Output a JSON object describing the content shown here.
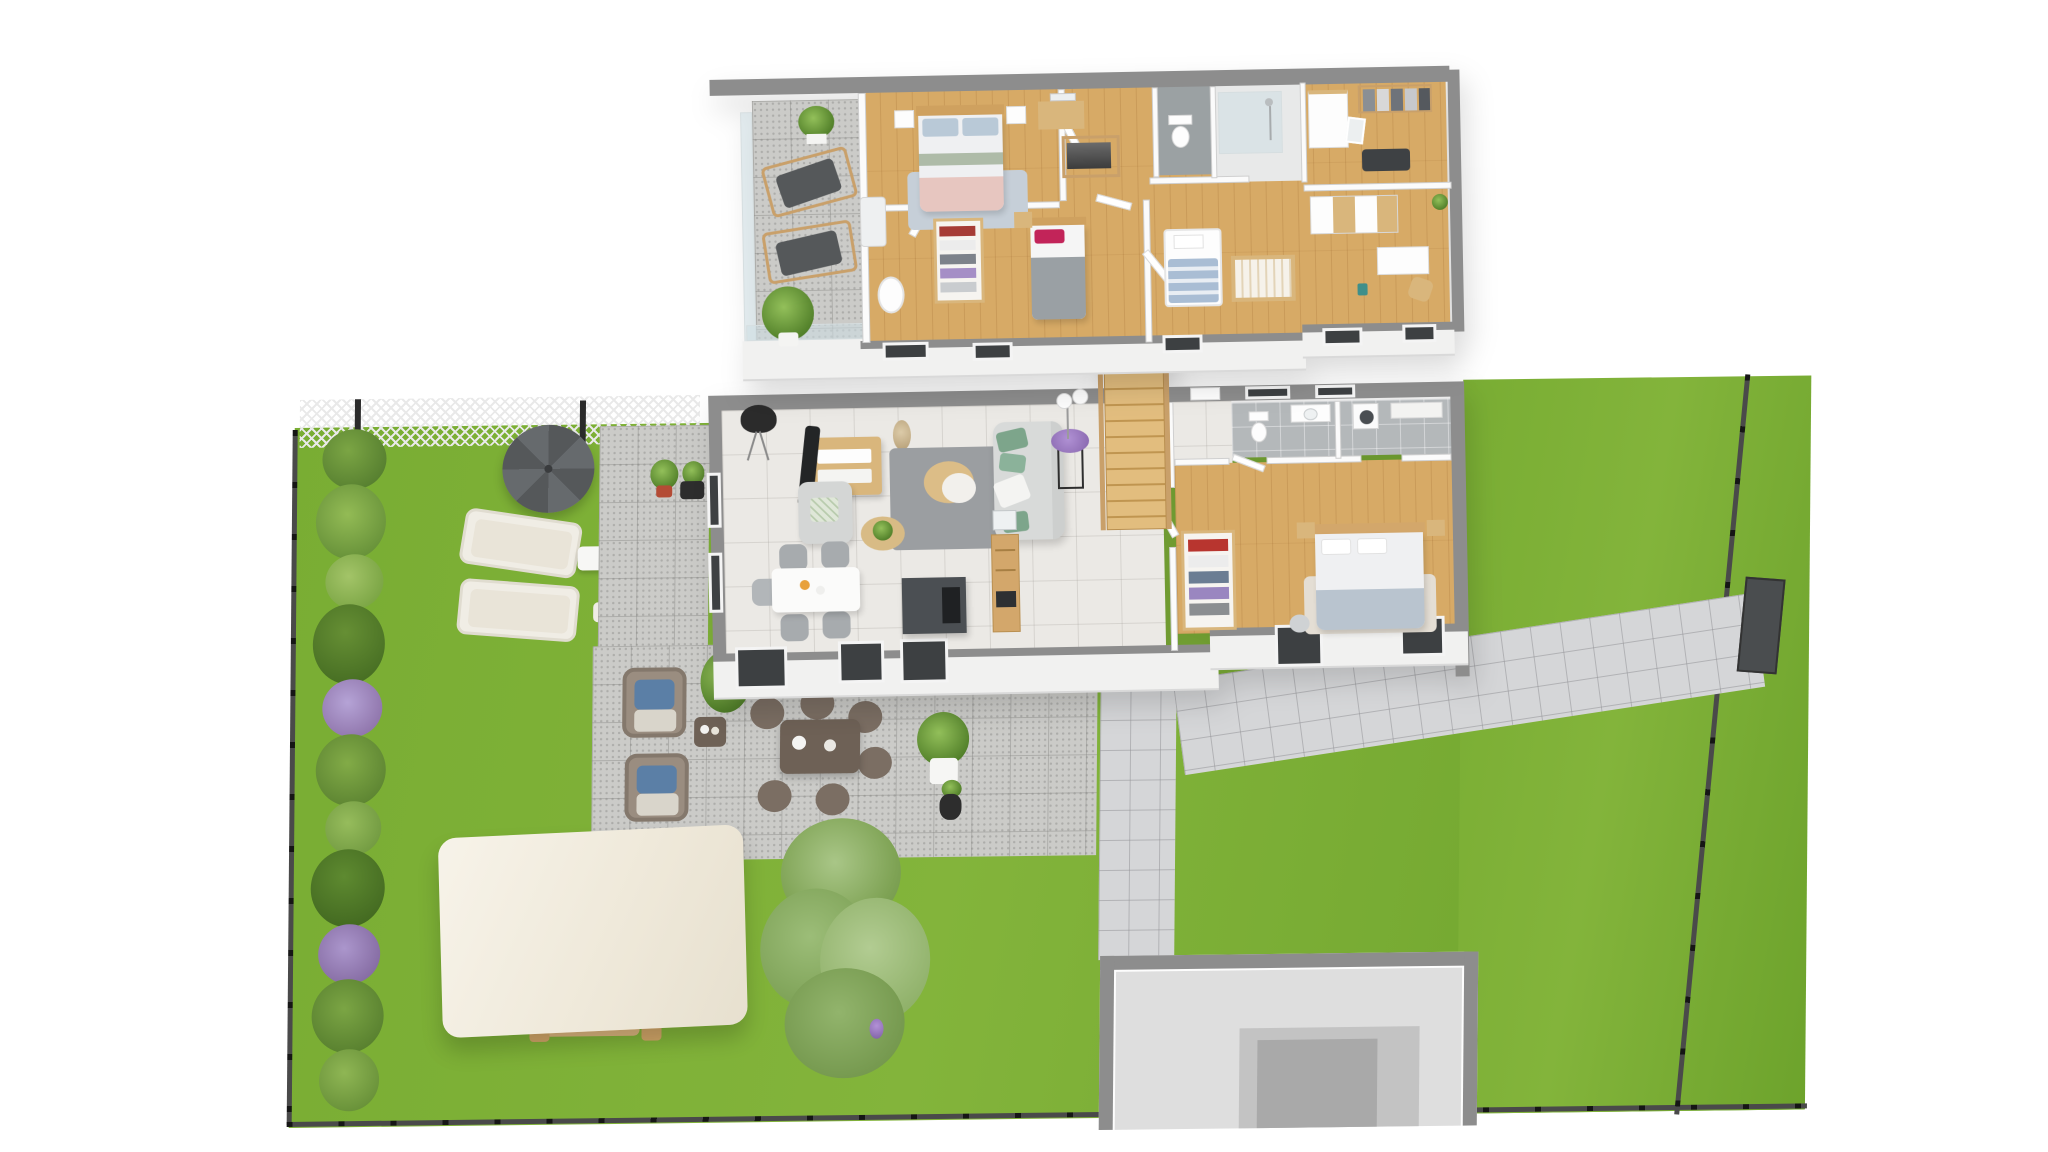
{
  "scene": {
    "title": "3D floor plan rendering - two-storey house with garden",
    "projection": "pseudo-isometric top-down view",
    "background": "#ffffff",
    "text_visible": "none"
  },
  "colors": {
    "grass": "#79ad33",
    "grass2": "#6da32c",
    "wallCap": "#8d8d8d",
    "wallFace": "#f1f1f0",
    "wood": "#d7aa66",
    "tile": "#ebe9e5",
    "terraceTile": "#cbcbc8",
    "pavers": "#d5d6d8",
    "bathTile": "#b4b8ba",
    "fence": "#2e2e2e",
    "hedgeGreen": "#6f9c3a",
    "hedgeDark": "#4f7c2b",
    "hedgeLight": "#8db252",
    "hedgePurple": "#9a84c0",
    "treeGreen": "#8fb168",
    "umbrella": "#5a5d5f",
    "loungerCushion": "#e9e4d8",
    "wicker": "#8a7d72",
    "outdoorTable": "#6e6156",
    "pergolaCanopy": "#f3eee2",
    "pergolaWood": "#c9a06a",
    "sofa": "#d8dad9",
    "cushionGreen": "#7da58b",
    "rugGray": "#9b9ea1",
    "tv": "#232526",
    "furnWood": "#d9b67c",
    "island": "#4b4f53",
    "chairGray": "#a7abae",
    "duvet": "#eff0f2",
    "pillowBlue": "#b9c9d7",
    "blanketPink": "#e7c6c0",
    "blanketGray": "#9aa0a4",
    "pillowMagenta": "#c22459",
    "blanketBlue": "#b9c4cf",
    "stairWood": "#e2bd7e",
    "glass": "#cfdfe4"
  },
  "upper_floor": {
    "label": "upper floor",
    "rooms": [
      {
        "name": "terrace",
        "floor": "stone tiles",
        "furniture": [
          "glass balustrade",
          "deck chair",
          "deck chair",
          "potted palm",
          "hanging plant"
        ]
      },
      {
        "name": "master bedroom",
        "floor": "wood",
        "furniture": [
          "double bed with blue pillows and pink throw",
          "nightstand",
          "nightstand",
          "white bench",
          "blue rug",
          "vanity desk with mirror",
          "open clothes rack"
        ]
      },
      {
        "name": "kids bedroom",
        "floor": "wood",
        "furniture": [
          "single bed with magenta pillow and gray blanket",
          "nightstand",
          "bassinet"
        ]
      },
      {
        "name": "landing",
        "floor": "wood",
        "furniture": [
          "stairwell railing",
          "open doors"
        ]
      },
      {
        "name": "wc",
        "floor": "gray tile",
        "furniture": [
          "toilet"
        ]
      },
      {
        "name": "shower room",
        "floor": "light tile",
        "furniture": [
          "walk-in glass shower"
        ]
      },
      {
        "name": "dressing room",
        "floor": "wood",
        "furniture": [
          "white dresser",
          "clothes rail",
          "leaning mirror",
          "dark rug"
        ]
      },
      {
        "name": "office bedroom",
        "floor": "wood",
        "furniture": [
          "white and wood sideboard",
          "desk",
          "wooden chair",
          "teal bin"
        ]
      },
      {
        "name": "nursery",
        "floor": "wood",
        "furniture": [
          "wooden crib",
          "toddler bed with blue blanket"
        ]
      }
    ]
  },
  "ground_floor": {
    "label": "ground floor",
    "rooms": [
      {
        "name": "living room",
        "floor": "light tile",
        "furniture": [
          "black tripod floor lamp",
          "curved tv",
          "wood and white tv stand",
          "pampas vase",
          "gray rug",
          "round two-tier coffee table",
          "light gray sofa with green cushions",
          "gray armchair with botanical pillow",
          "round side table with plant",
          "black plant stand with purple flowers",
          "double-globe floor lamp"
        ]
      },
      {
        "name": "dining area",
        "floor": "light tile",
        "furniture": [
          "white dining table",
          "gray upholstered chair x5"
        ]
      },
      {
        "name": "kitchen",
        "floor": "light tile",
        "furniture": [
          "dark gray island with induction hob",
          "tall wooden unit with built-in oven",
          "glass wall cabinet"
        ]
      },
      {
        "name": "staircase",
        "furniture": [
          "wooden quarter-turn staircase with railing"
        ]
      },
      {
        "name": "bathroom laundry",
        "floor": "gray tile",
        "furniture": [
          "toilet",
          "washbasin vanity",
          "washing machine",
          "counter"
        ]
      },
      {
        "name": "bedroom",
        "floor": "wood",
        "furniture": [
          "double bed with white duvet and blue throw",
          "nightstand",
          "nightstand",
          "open wardrobe rack with clothes",
          "beige rug",
          "pouf"
        ]
      }
    ]
  },
  "garden": {
    "features": [
      "black perimeter fence with posts",
      "white wire mesh fence at top left",
      "mixed hedge with purple shrubs along left boundary",
      "dark gray parasol",
      "two cream sun loungers",
      "white side table",
      "stone patio along west wall",
      "red and black potted plants",
      "large paved terrace",
      "two wicker lounge chairs with blue cushions",
      "outdoor side table",
      "wicker dining table with six chairs",
      "white planter with shrub",
      "black vase with grasses",
      "pergola with white canopy and wood posts",
      "wooden garden dining set under pergola",
      "large feathery tree",
      "small purple flower",
      "paver path from house to side gate",
      "dark side gate",
      "sunken basement entrance with gray walls",
      "large lawn"
    ]
  }
}
